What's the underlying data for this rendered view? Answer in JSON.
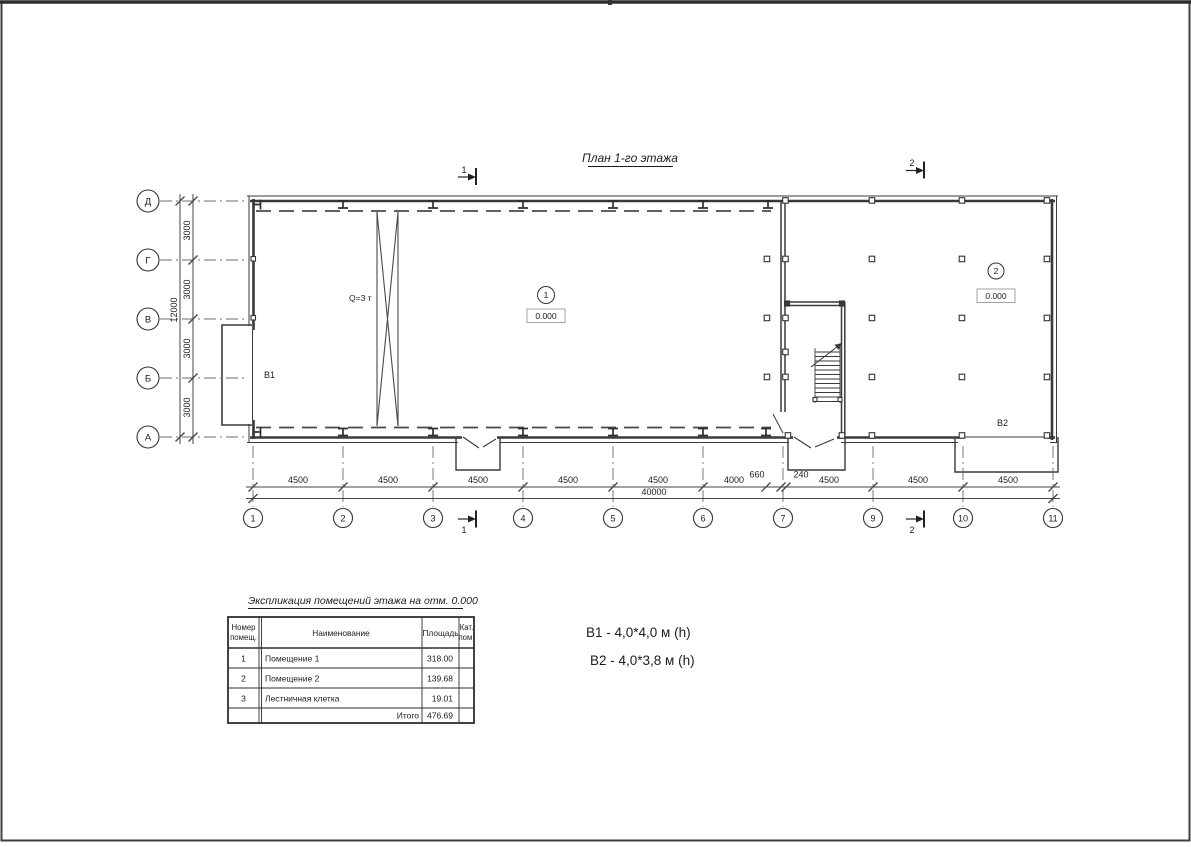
{
  "sheet": {
    "title": "План 1-го этажа",
    "section_marks": {
      "s1": "1",
      "s2": "2"
    },
    "axes": {
      "vertical": [
        "Д",
        "Г",
        "В",
        "Б",
        "А"
      ],
      "horizontal": [
        "1",
        "2",
        "3",
        "4",
        "5",
        "6",
        "7",
        "9",
        "10",
        "11"
      ]
    },
    "dimensions": {
      "bottom_row": [
        "4500",
        "4500",
        "4500",
        "4500",
        "4500",
        "4000",
        "660",
        "240",
        "4500",
        "4500",
        "4500"
      ],
      "bottom_total": "40000",
      "left_row": [
        "3000",
        "3000",
        "3000",
        "3000"
      ],
      "left_total": "12000"
    },
    "labels": {
      "crane": "Q=3 т",
      "gate_b1": "B1",
      "gate_b2": "B2"
    },
    "rooms": [
      {
        "number": "1",
        "elevation": "0.000"
      },
      {
        "number": "2",
        "elevation": "0.000"
      }
    ]
  },
  "legend": {
    "b1": "B1  -  4,0*4,0 м (h)",
    "b2": "B2 - 4,0*3,8 м (h)"
  },
  "table": {
    "title": "Экспликация помещений этажа на отм. 0.000",
    "headers": {
      "col1_line1": "Номер",
      "col1_line2": "помещ.",
      "col2": "Наименование",
      "col3": "Площадь",
      "col4_line1": "Кат.",
      "col4_line2": "пом."
    },
    "rows": [
      {
        "num": "1",
        "name": "Помещение 1",
        "area": "318.00",
        "cat": ""
      },
      {
        "num": "2",
        "name": "Помещение 2",
        "area": "139.68",
        "cat": ""
      },
      {
        "num": "3",
        "name": "Лестничная клетка",
        "area": "19.01",
        "cat": ""
      }
    ],
    "total_label": "Итого",
    "total_value": "476.69"
  },
  "colors": {
    "line": "#3a3a3a",
    "text": "#1c1c1c"
  }
}
